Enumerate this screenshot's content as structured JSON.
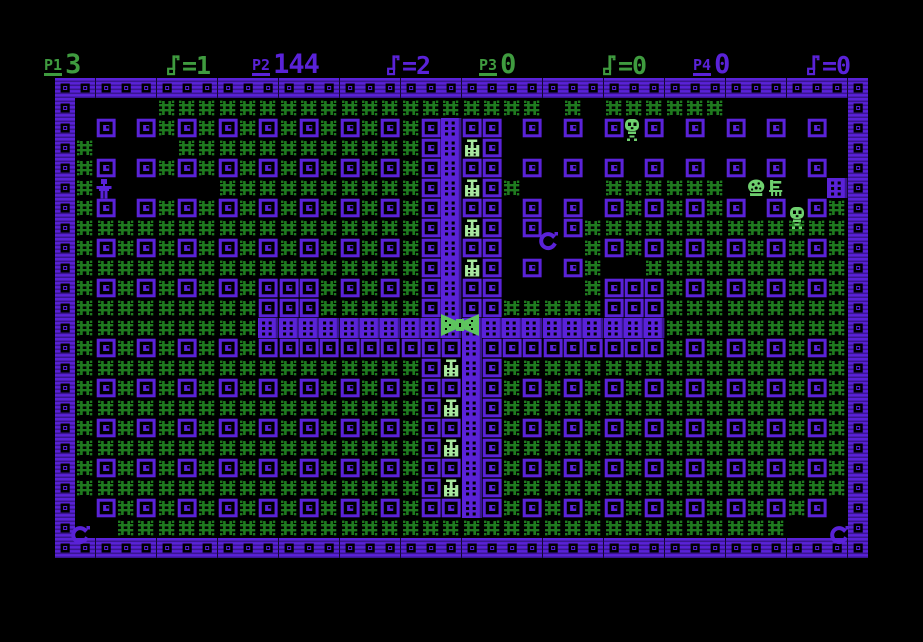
{
  "hud": {
    "players": [
      {
        "id": "P1",
        "score": "3",
        "keys": "=1",
        "color": "green",
        "x": 44,
        "kx": 166
      },
      {
        "id": "P2",
        "score": "144",
        "keys": "=2",
        "color": "purple",
        "x": 252,
        "kx": 386
      },
      {
        "id": "P3",
        "score": "0",
        "keys": "=0",
        "color": "green",
        "x": 479,
        "kx": 602
      },
      {
        "id": "P4",
        "score": "0",
        "keys": "=0",
        "color": "purple",
        "x": 693,
        "kx": 806
      }
    ]
  },
  "colors": {
    "background": "#000000",
    "purple": "#5a22d8",
    "purple_dark": "#3a1591",
    "grass_green": "#1f7a1f",
    "hud_green": "#3f9b3f",
    "bright_green": "#6fd06f",
    "pale_green": "#a9e8a0",
    "bowtie_green": "#5ec45e"
  },
  "playfield": {
    "cols": 40,
    "rows": 24,
    "tile_w": 20.325,
    "tile_h": 20,
    "left": 55,
    "top": 78,
    "legend": {
      "E": "tile-edge-wall",
      "W": "tile-wall-block",
      "G": "tile-grass",
      "D": "tile-dotted-door",
      "C": "tile-crown-item",
      "H": "tile-heap-item",
      "F": "tile-hatch-item",
      ".": "tile-empty"
    },
    "map": [
      "EEEEEEEEEEEEEEEEEEEEEEEEEEEEEEEEEEEEEEEE",
      "E....GGGGGGGGGGGGGGGGGGG.G.GGGGGG......E",
      "E.W.WGWGWGWGWGWGWGWDWW.W.W.W.W.W.W.W.W.E",
      "EG....GGGGGGGGGGGGWDCW.................E",
      "EGW.WGWGWGWGWGWGWGWDWW.W.W.W.W.W.W.W.W.E",
      "EG......GGGGGGGGGGWDCWG....GGGGGG.HF..DE",
      "EGW.WGWGWGWGWGWGWGWDWW.W.W.WGWGWGW.W.WGE",
      "EGGGGGGGGGGGGGGGGGWDCW.W.WGGGGGGGGGGGGGE",
      "EGWGWGWGWGWGWGWGWGWDWW....GWGWGWGWGWGWGE",
      "EGGGGGGGGGGGGGGGGGWDCW.W.WG..GGGGGGGGGGE",
      "EGWGWGWGWGWWWGWGWGWDWW....GWWWGWGWGWGWGE",
      "EGGGGGGGGGWWWGGGGGWDWWGGGGGWWWGGGGGGGGGE",
      "EGGGGGGGGGDDDDDDDDDDDDDDDDDDDDGGGGGGGGGE",
      "EGWGWGWGWGWWWWWWWWWWDWWWWWWWWWGWGWGWGWGE",
      "EGGGGGGGGGGGGGGGGGWCDWGGGGGGGGGGGGGGGGGE",
      "EGWGWGWGWGWGWGWGWGWWDWGWGWGWGWGWGWGWGWGE",
      "EGGGGGGGGGGGGGGGGGWCDWGGGGGGGGGGGGGGGGGE",
      "EGWGWGWGWGWGWGWGWGWWDWGWGWGWGWGWGWGWGWGE",
      "EGGGGGGGGGGGGGGGGGWCDWGGGGGGGGGGGGGGGGGE",
      "EGWGWGWGWGWGWGWGWGWWDWGWGWGWGWGWGWGWGWGE",
      "EGGGGGGGGGGGGGGGGGWCDWGGGGGGGGGGGGGGGGGE",
      "E.WGWGWGWGWGWGWGWGWWDWGWGWGWGWGWGWGWGW.E",
      "E..GGGGGGGGGGGGGGGGGGGGGGGGGGGGGGGGG...E",
      "EEEEEEEEEEEEEEEEEEEEEEEEEEEEEEEEEEEEEEEE"
    ],
    "sprites": [
      {
        "type": "player",
        "name": "sprite-player-purple",
        "col": 2,
        "row": 5,
        "dx": -2,
        "dy": 1,
        "w": 20,
        "h": 24
      },
      {
        "type": "skull",
        "name": "sprite-skull-monster",
        "col": 28,
        "row": 2,
        "dx": -2,
        "dy": 0,
        "w": 20,
        "h": 24
      },
      {
        "type": "skull",
        "name": "sprite-skull-monster",
        "col": 36,
        "row": 6,
        "dx": 0,
        "dy": 8,
        "w": 20,
        "h": 24
      },
      {
        "type": "swirl",
        "name": "sprite-swirl-monster",
        "col": 24,
        "row": 7,
        "dx": -7,
        "dy": 12,
        "w": 24,
        "h": 24
      },
      {
        "type": "swirl",
        "name": "sprite-swirl-monster",
        "col": 1,
        "row": 22,
        "dx": -7,
        "dy": 6,
        "w": 24,
        "h": 24
      },
      {
        "type": "swirl",
        "name": "sprite-swirl-monster",
        "col": 38,
        "row": 22,
        "dx": 0,
        "dy": 6,
        "w": 24,
        "h": 24
      },
      {
        "type": "bowtie",
        "name": "sprite-bowtie-item",
        "col": 19,
        "row": 12,
        "dx": -3,
        "dy": -6,
        "w": 44,
        "h": 26
      }
    ]
  }
}
